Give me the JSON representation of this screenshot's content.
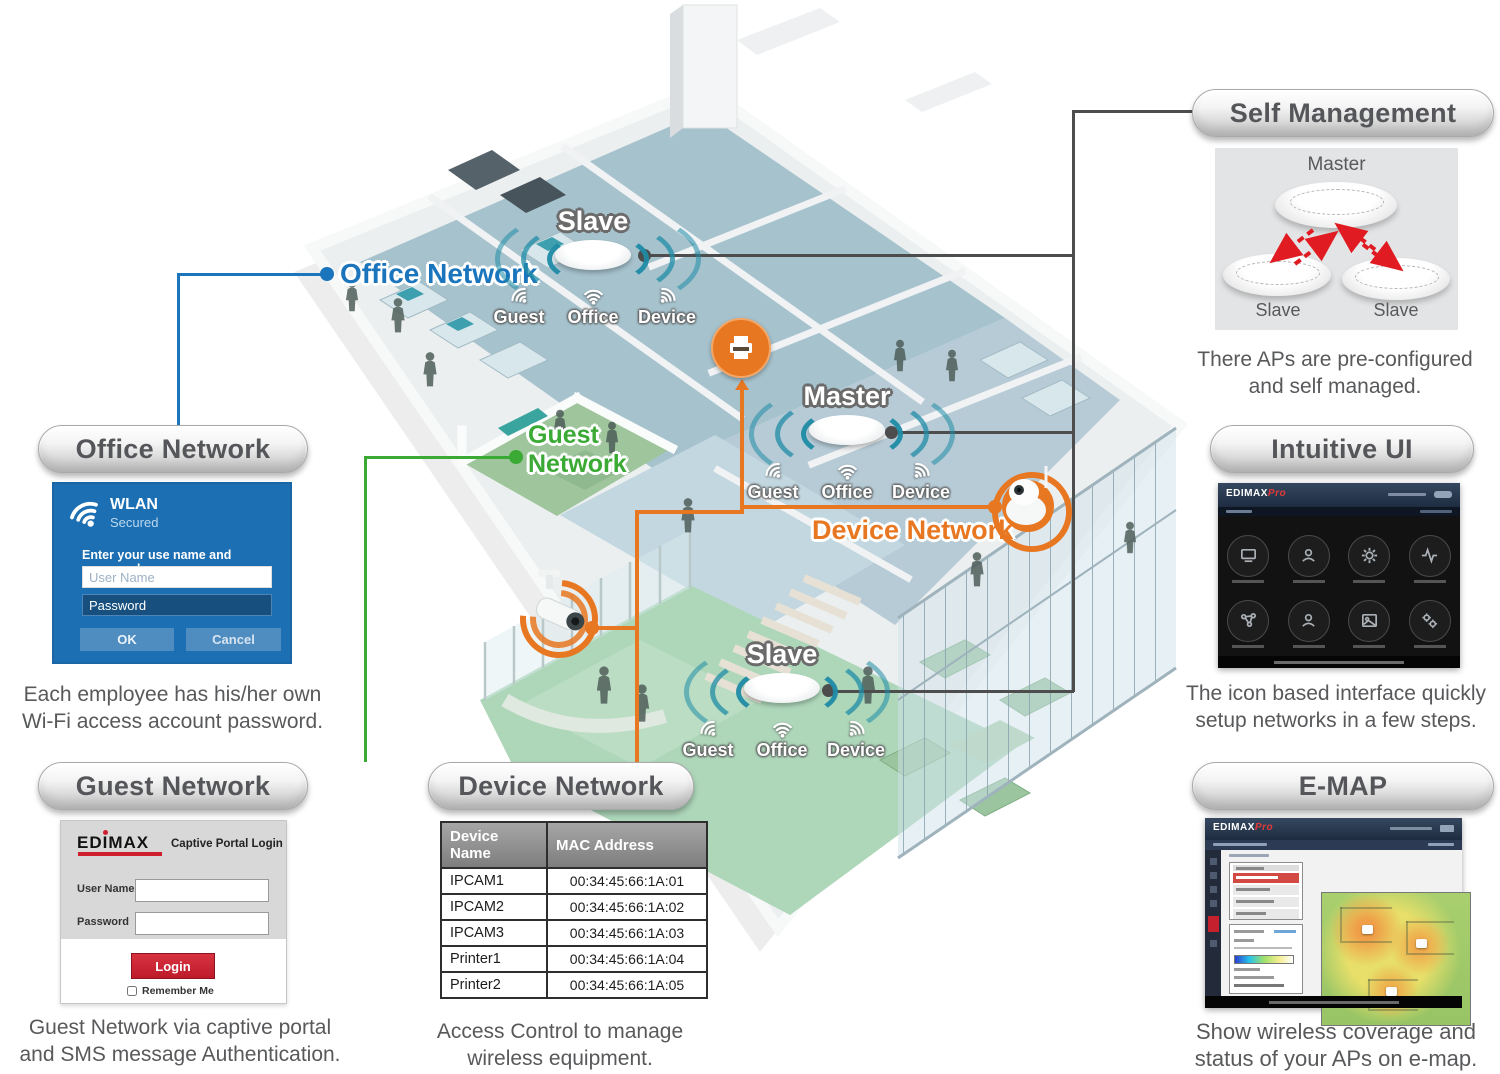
{
  "floorplan": {
    "office_label": "Office Network",
    "guest_label_line1": "Guest",
    "guest_label_line2": "Network",
    "device_label": "Device Network",
    "aps": [
      {
        "name": "Slave",
        "signals": [
          "Guest",
          "Office",
          "Device"
        ]
      },
      {
        "name": "Master",
        "signals": [
          "Guest",
          "Office",
          "Device"
        ]
      },
      {
        "name": "Slave",
        "signals": [
          "Guest",
          "Office",
          "Device"
        ]
      }
    ]
  },
  "office_panel": {
    "title": "Office Network",
    "wlan": {
      "name": "WLAN",
      "status": "Secured",
      "prompt": "Enter your use name and password",
      "username_placeholder": "User Name",
      "password_value": "Password",
      "ok": "OK",
      "cancel": "Cancel"
    },
    "caption1": "Each employee has his/her own",
    "caption2": "Wi-Fi access account password."
  },
  "guest_panel": {
    "title": "Guest Network",
    "portal": {
      "brand": "EDIMAX",
      "heading": "Captive Portal Login",
      "username_label": "User Name",
      "password_label": "Password",
      "login": "Login",
      "remember": "Remember Me"
    },
    "caption1": "Guest Network via captive portal",
    "caption2": "and SMS message Authentication."
  },
  "device_panel": {
    "title": "Device Network",
    "headers": [
      "Device Name",
      "MAC Address"
    ],
    "rows": [
      [
        "IPCAM1",
        "00:34:45:66:1A:01"
      ],
      [
        "IPCAM2",
        "00:34:45:66:1A:02"
      ],
      [
        "IPCAM3",
        "00:34:45:66:1A:03"
      ],
      [
        "Printer1",
        "00:34:45:66:1A:04"
      ],
      [
        "Printer2",
        "00:34:45:66:1A:05"
      ]
    ],
    "caption1": "Access Control to manage",
    "caption2": "wireless equipment."
  },
  "self_panel": {
    "title": "Self Management",
    "master": "Master",
    "slave_left": "Slave",
    "slave_right": "Slave",
    "caption1": "There APs are pre-configured",
    "caption2": "and self managed."
  },
  "ui_panel": {
    "title": "Intuitive UI",
    "brand": "EDIMAX",
    "brand_pro": "Pro",
    "caption1": "The icon based interface quickly",
    "caption2": "setup networks in a few steps."
  },
  "emap_panel": {
    "title": "E-MAP",
    "brand": "EDIMAX",
    "brand_pro": "Pro",
    "caption1": "Show wireless coverage and",
    "caption2": "status of your APs on e-map."
  }
}
